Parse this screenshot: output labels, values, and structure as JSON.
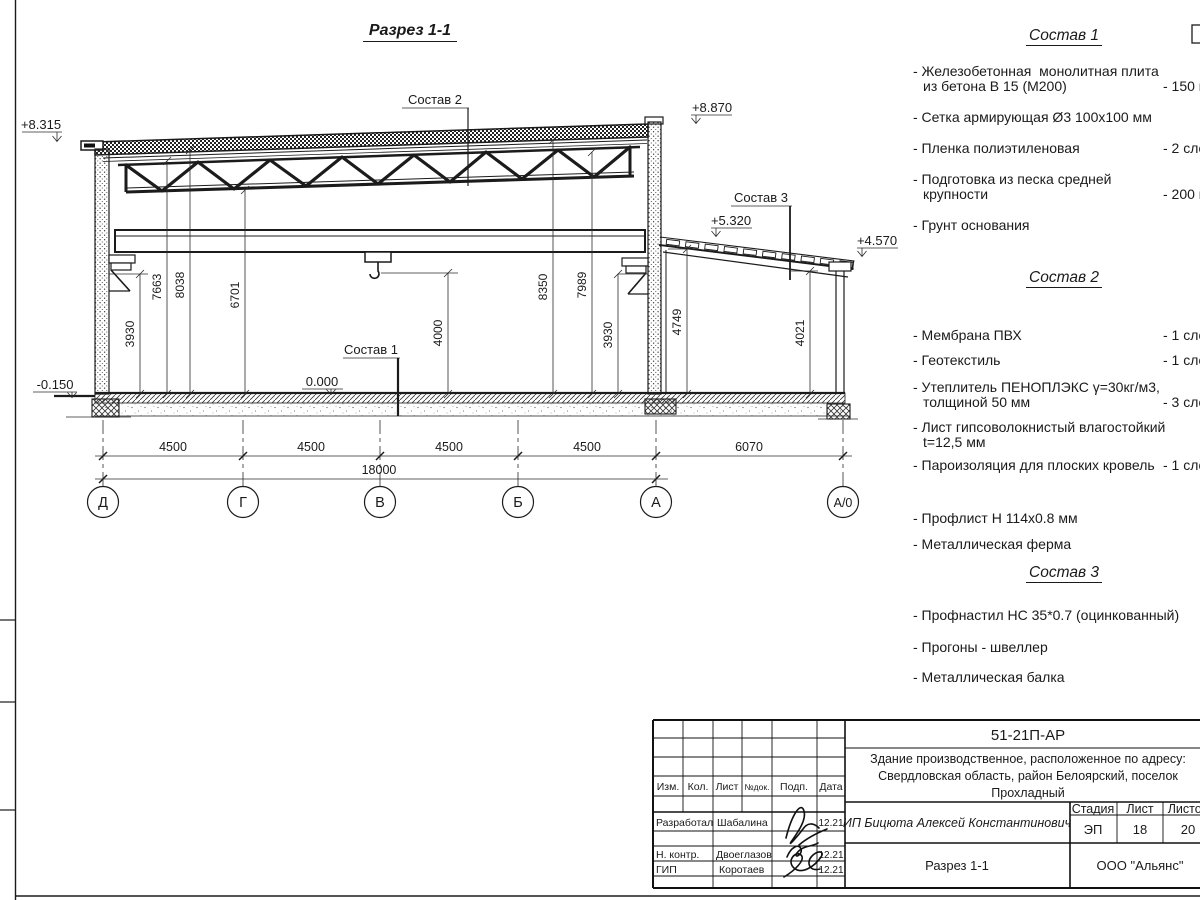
{
  "sheet": {
    "section_title": "Разрез 1-1",
    "elevations": {
      "e8315": "+8.315",
      "e8870": "+8.870",
      "e5320": "+5.320",
      "e4570": "+4.570",
      "e0000": "0.000",
      "em0150": "-0.150"
    },
    "leaders": {
      "s1": "Состав 1",
      "s2": "Состав 2",
      "s3": "Состав 3"
    },
    "vdims": {
      "v3930l": "3930",
      "v7663": "7663",
      "v8038": "8038",
      "v6701": "6701",
      "v4000": "4000",
      "v8350": "8350",
      "v7989": "7989",
      "v3930r": "3930",
      "v4749": "4749",
      "v4021": "4021"
    },
    "hdims": {
      "s1": "4500",
      "s2": "4500",
      "s3": "4500",
      "s4": "4500",
      "s5": "6070",
      "total": "18000"
    },
    "axes": {
      "a1": "Д",
      "a2": "Г",
      "a3": "В",
      "a4": "Б",
      "a5": "А",
      "a6": "А/0"
    }
  },
  "compositions": [
    {
      "title": "Состав 1",
      "items": [
        {
          "name": "- Железобетонная  монолитная плита\nиз бетона В 15 (М200)",
          "value": "- 150 мм"
        },
        {
          "name": "- Сетка армирующая Ø3 100х100 мм",
          "value": ""
        },
        {
          "name": "- Пленка полиэтиленовая",
          "value": "-  2 слоя"
        },
        {
          "name": "- Подготовка из песка средней\nкрупности",
          "value": "- 200 мм"
        },
        {
          "name": "- Грунт основания",
          "value": ""
        }
      ]
    },
    {
      "title": "Состав 2",
      "items": [
        {
          "name": "- Мембрана ПВХ",
          "value": "- 1 слой"
        },
        {
          "name": "- Геотекстиль",
          "value": "- 1 слой"
        },
        {
          "name": "- Утеплитель ПЕНОПЛЭКС γ=30кг/м3,\nтолщиной 50 мм",
          "value": "- 3 слоя"
        },
        {
          "name": "- Лист гипсоволокнистый влагостойкий\nt=12,5 мм",
          "value": ""
        },
        {
          "name": "- Пароизоляция для плоских кровель",
          "value": "- 1 слой"
        },
        {
          "name": "- Профлист Н 114х0.8 мм",
          "value": ""
        },
        {
          "name": "- Металлическая ферма",
          "value": ""
        }
      ]
    },
    {
      "title": "Состав 3",
      "items": [
        {
          "name": "- Профнастил НС 35*0.7 (оцинкованный)",
          "value": ""
        },
        {
          "name": "- Прогоны - швеллер",
          "value": ""
        },
        {
          "name": "- Металлическая балка",
          "value": ""
        }
      ]
    }
  ],
  "titleblock": {
    "doc_number": "51-21П-АР",
    "project_name1": "Здание производственное, расположенное по адресу:",
    "project_name2": "Свердловская область, район Белоярский, поселок",
    "project_name3": "Прохладный",
    "client": "ИП Бицюта Алексей Константинович",
    "sheet_title": "Разрез 1-1",
    "company": "ООО \"Альянс\"",
    "stage_label": "Стадия",
    "sheet_label": "Лист",
    "sheets_label": "Листов",
    "stage": "ЭП",
    "sheet_no": "18",
    "sheets_total": "20",
    "cols": {
      "izm": "Изм.",
      "kol": "Кол.",
      "list": "Лист",
      "ndok": "№док.",
      "podp": "Подп.",
      "data": "Дата"
    },
    "rows": [
      {
        "role": "Разработал",
        "name": "Шабалина",
        "date": "12.21"
      },
      {
        "role": "Н. контр.",
        "name": "Двоеглазов",
        "date": "12.21"
      },
      {
        "role": "ГИП",
        "name": "Коротаев",
        "date": "12.21"
      }
    ]
  }
}
